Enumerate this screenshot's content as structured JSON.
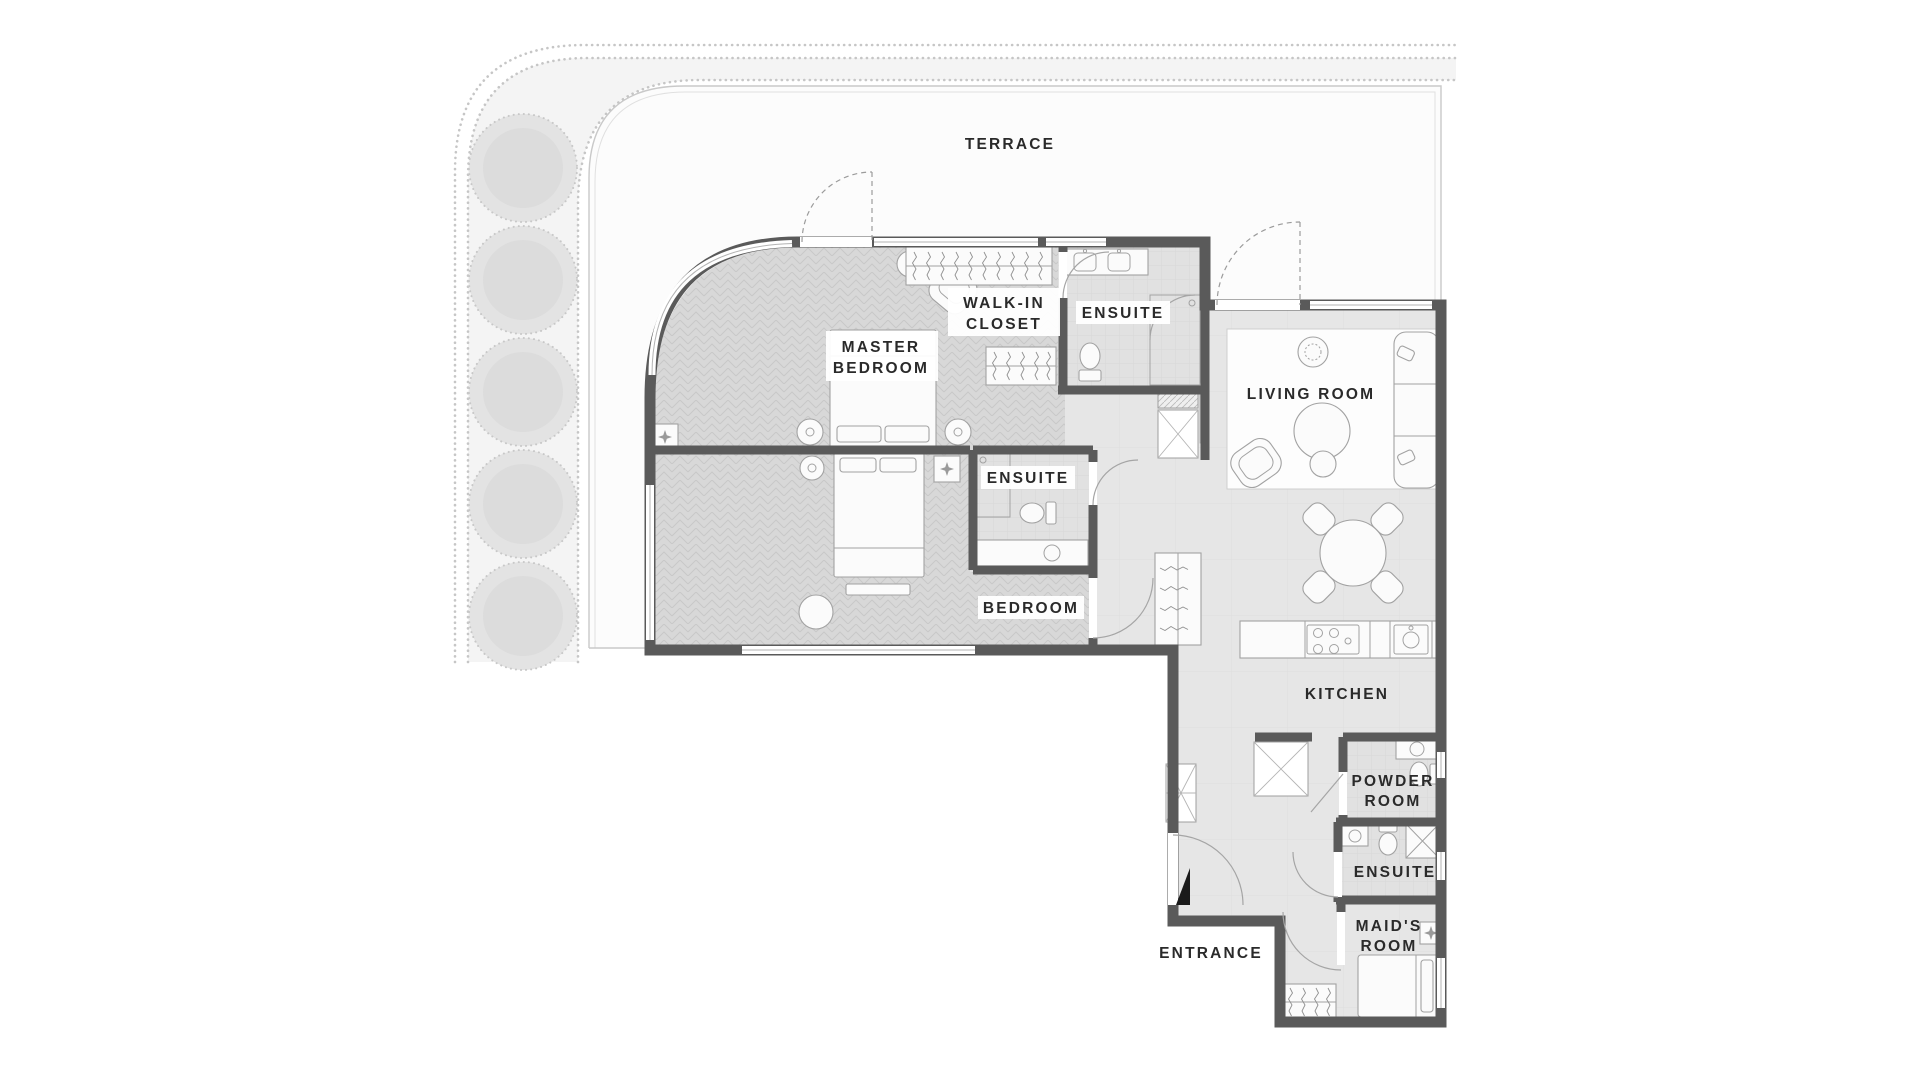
{
  "plan": {
    "title": "Apartment floor plan",
    "colors": {
      "wall": "#5a5a5a",
      "label_text": "#2a2a2a",
      "floor_bedroom": "#d8d8d8",
      "floor_living": "#e6e6e6",
      "floor_bath": "#e1e1e1",
      "terrace_fill": "#fcfcfc",
      "terrace_border": "#c9c9c9",
      "garden_band": "#f4f4f4",
      "tree": "#e3e3e3",
      "furniture_outline": "#a2a2a2",
      "entrance_marker": "#1a1a1a"
    },
    "labels": {
      "terrace": "TERRACE",
      "master_bedroom": {
        "line1": "MASTER",
        "line2": "BEDROOM"
      },
      "walk_in_closet": {
        "line1": "WALK-IN",
        "line2": "CLOSET"
      },
      "ensuite_master": "ENSUITE",
      "living_room": "LIVING ROOM",
      "ensuite_bedroom": "ENSUITE",
      "bedroom": "BEDROOM",
      "kitchen": "KITCHEN",
      "powder_room": {
        "line1": "POWDER",
        "line2": "ROOM"
      },
      "ensuite_maid": "ENSUITE",
      "maids_room": {
        "line1": "MAID'S",
        "line2": "ROOM"
      },
      "entrance": "ENTRANCE"
    },
    "rooms": [
      "TERRACE",
      "MASTER BEDROOM",
      "WALK-IN CLOSET",
      "ENSUITE",
      "LIVING ROOM",
      "ENSUITE",
      "BEDROOM",
      "KITCHEN",
      "POWDER ROOM",
      "ENSUITE",
      "MAID'S ROOM",
      "ENTRANCE"
    ]
  }
}
